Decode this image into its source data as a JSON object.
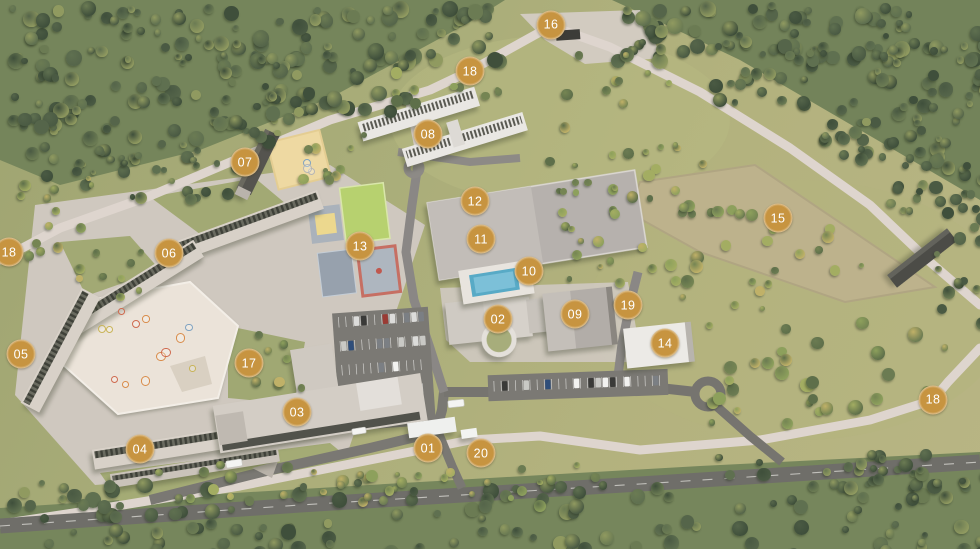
{
  "marker_style": {
    "background": "#c79440",
    "text_color": "#ffffff"
  },
  "markers": [
    {
      "label": "01",
      "x": 428,
      "y": 448
    },
    {
      "label": "02",
      "x": 498,
      "y": 319
    },
    {
      "label": "03",
      "x": 297,
      "y": 412
    },
    {
      "label": "04",
      "x": 140,
      "y": 449
    },
    {
      "label": "05",
      "x": 21,
      "y": 354
    },
    {
      "label": "06",
      "x": 169,
      "y": 253
    },
    {
      "label": "07",
      "x": 245,
      "y": 162
    },
    {
      "label": "08",
      "x": 428,
      "y": 134
    },
    {
      "label": "09",
      "x": 575,
      "y": 314
    },
    {
      "label": "10",
      "x": 529,
      "y": 271
    },
    {
      "label": "11",
      "x": 481,
      "y": 239
    },
    {
      "label": "12",
      "x": 475,
      "y": 201
    },
    {
      "label": "13",
      "x": 360,
      "y": 246
    },
    {
      "label": "14",
      "x": 665,
      "y": 343
    },
    {
      "label": "15",
      "x": 778,
      "y": 218
    },
    {
      "label": "16",
      "x": 551,
      "y": 25
    },
    {
      "label": "17",
      "x": 249,
      "y": 363
    },
    {
      "label": "18",
      "x": 470,
      "y": 71
    },
    {
      "label": "18",
      "x": 9,
      "y": 252
    },
    {
      "label": "18",
      "x": 933,
      "y": 400
    },
    {
      "label": "19",
      "x": 628,
      "y": 305
    },
    {
      "label": "20",
      "x": 481,
      "y": 453
    }
  ]
}
